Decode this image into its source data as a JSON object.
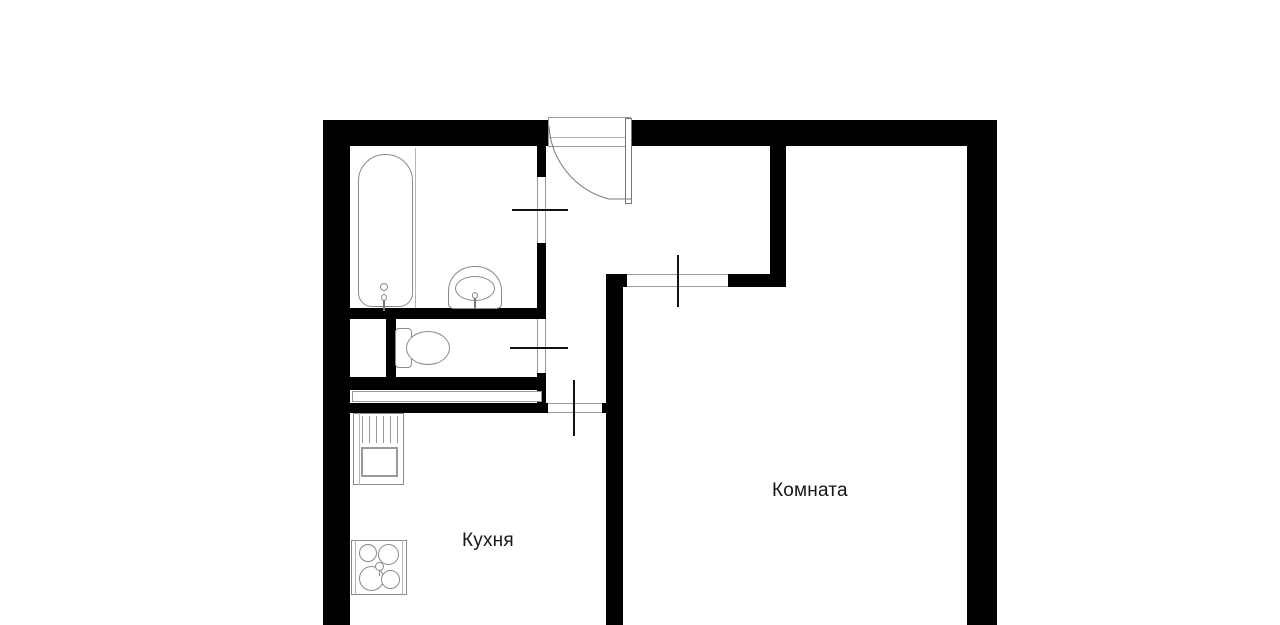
{
  "labels": {
    "kitchen": "Кухня",
    "room": "Комната"
  },
  "fixtures": [
    "bathtub",
    "bathroom-sink",
    "toilet",
    "kitchen-sink-unit",
    "stove-4-burner",
    "entrance-door"
  ],
  "colors": {
    "wall": "#000000",
    "background": "#ffffff",
    "fixture_outline": "#8a8a8a",
    "door_tick": "#111111",
    "text": "#161616"
  }
}
